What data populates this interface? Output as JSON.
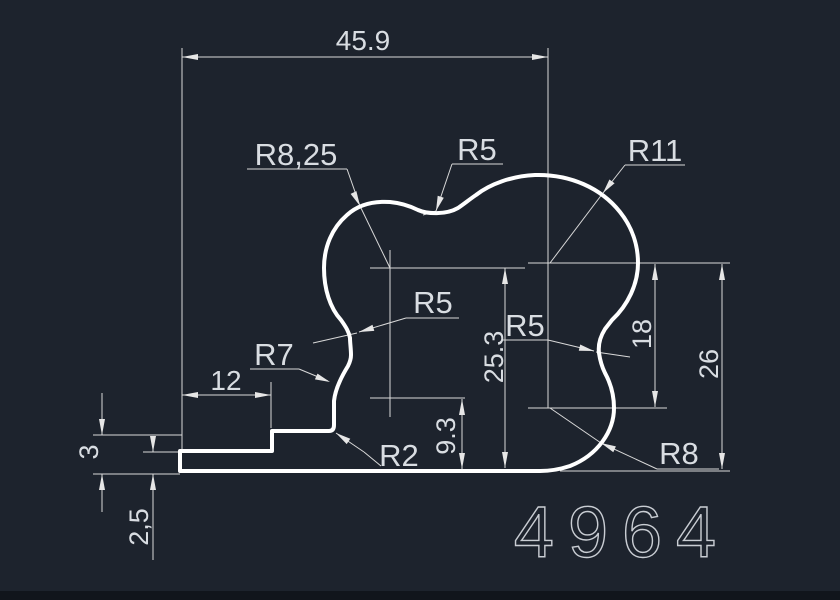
{
  "drawing": {
    "part_number": "4964",
    "dimensions": {
      "overall_width": "45.9",
      "flange_length": "12",
      "step_height": "3",
      "flange_thickness": "2,5",
      "height_mid": "25.3",
      "height_small": "9.3",
      "height_inner_right": "18",
      "height_outer_right": "26"
    },
    "radii": {
      "r8_25": "R8,25",
      "r5_top": "R5",
      "r11": "R11",
      "r5_left": "R5",
      "r5_right": "R5",
      "r7": "R7",
      "r2": "R2",
      "r8": "R8"
    }
  },
  "colors": {
    "background": "#1d232d",
    "bottom_strip": "#11151c",
    "profile_line": "#ffffff",
    "dimension_line": "#d9d9d9",
    "text": "#d9dde2"
  }
}
